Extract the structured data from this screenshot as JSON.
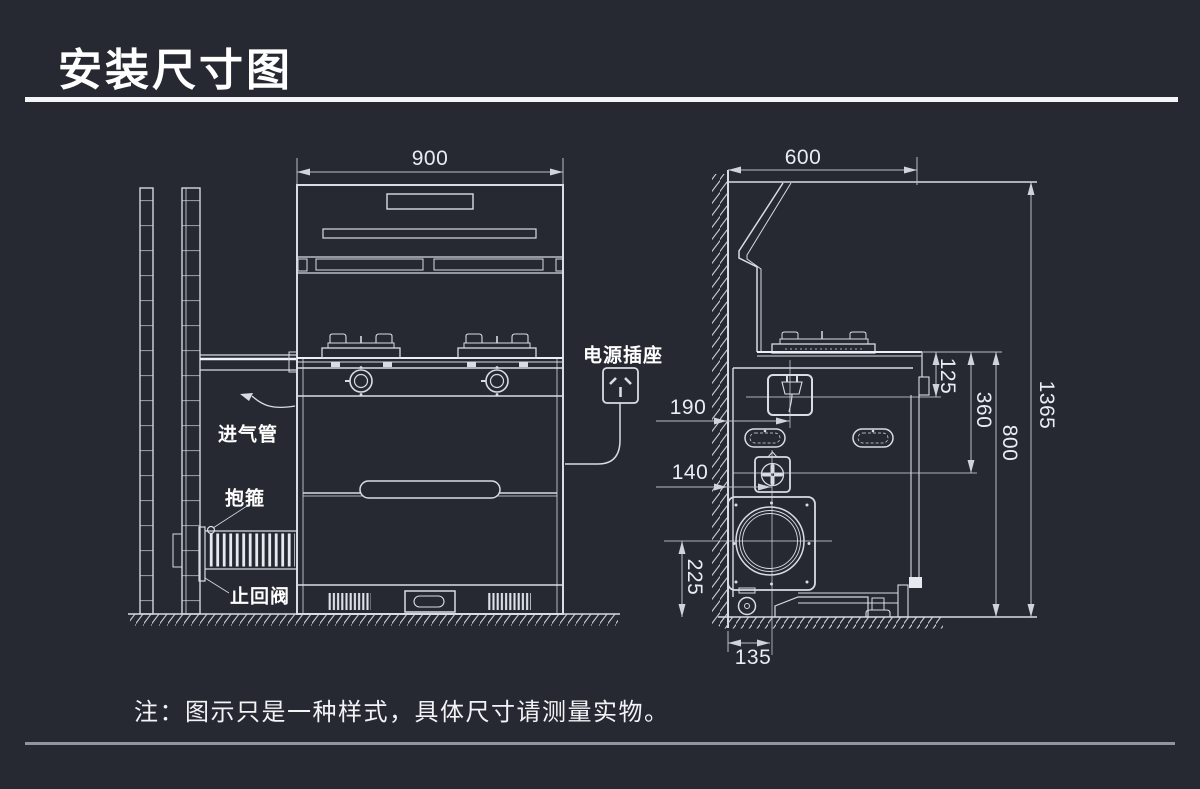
{
  "page": {
    "title": "安装尺寸图",
    "note": "注：图示只是一种样式，具体尺寸请测量实物。"
  },
  "front_view": {
    "width": "900",
    "labels": {
      "gas_inlet_pipe": "进气管",
      "clamp": "抱箍",
      "check_valve": "止回阀",
      "power_socket": "电源插座"
    }
  },
  "side_view": {
    "depth": "600",
    "socket_from_wall": "190",
    "valve_from_wall": "140",
    "outlet_center_height": "225",
    "outlet_center_from_wall": "135",
    "socket_below_countertop": "125",
    "valve_below_countertop": "360",
    "countertop_height": "800",
    "total_height": "1365"
  },
  "colors": {
    "background": "#262932",
    "line": "#d9dce2",
    "dim_line": "#b8bdc5",
    "text": "#ffffff"
  }
}
